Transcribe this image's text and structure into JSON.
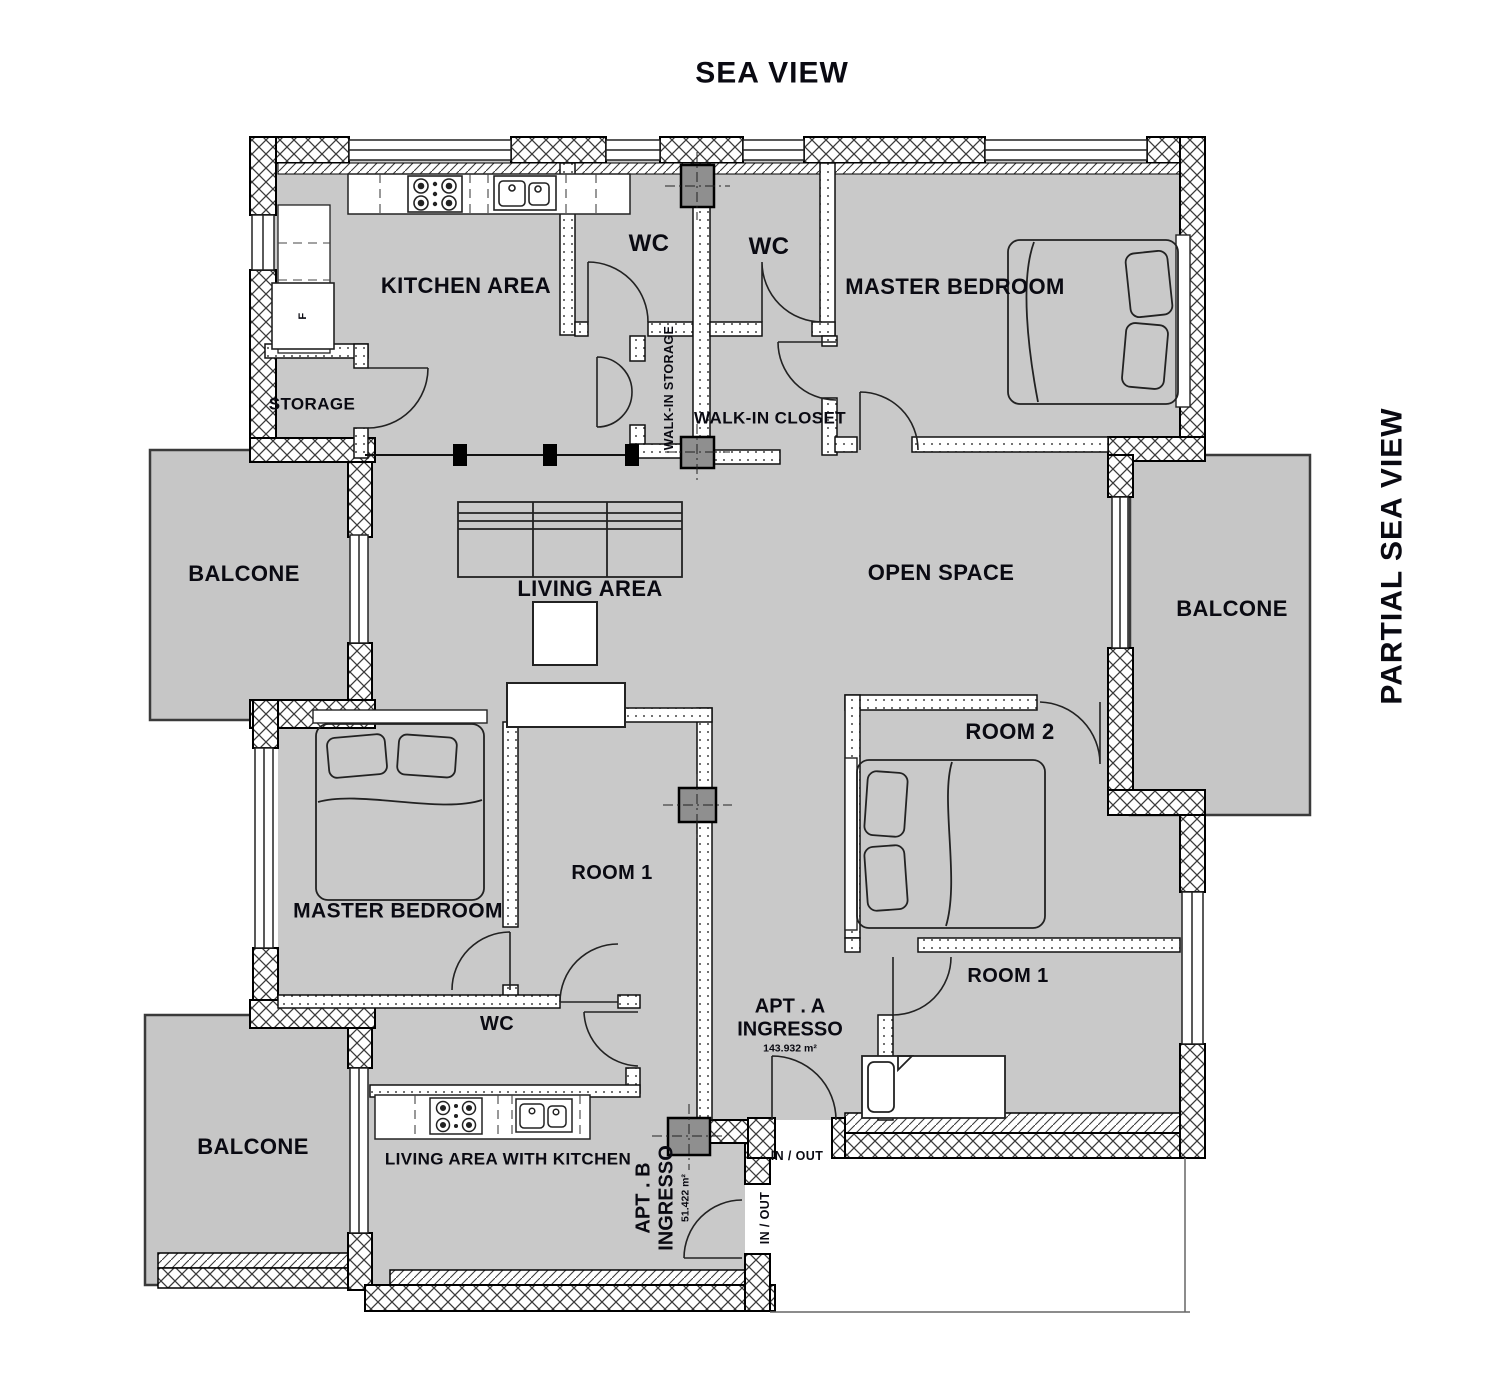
{
  "title": "SEA VIEW",
  "side_title": "PARTIAL SEA VIEW",
  "apt_a": {
    "name": "APT . A",
    "type": "INGRESSO",
    "area": "143.932 m²"
  },
  "apt_b": {
    "name": "APT . B",
    "type": "INGRESSO",
    "area": "51.422 m²"
  },
  "rooms": {
    "kitchen": "KITCHEN AREA",
    "wc1": "WC",
    "wc2": "WC",
    "wc3": "WC",
    "master_top": "MASTER BEDROOM",
    "master_bottom": "MASTER BEDROOM",
    "storage": "STORAGE",
    "walk_in_storage": "WALK-IN STORAGE",
    "walk_in_closet": "WALK-IN CLOSET",
    "balcone_left": "BALCONE",
    "balcone_right": "BALCONE",
    "balcone_bottom": "BALCONE",
    "living": "LIVING AREA",
    "open_space": "OPEN SPACE",
    "room2": "ROOM 2",
    "room1_a": "ROOM 1",
    "room1_b": "ROOM 1",
    "living_kitchen": "LIVING AREA WITH KITCHEN"
  },
  "annotations": {
    "fridge": "F",
    "in_out_a": "IN / OUT",
    "in_out_b": "IN / OUT"
  },
  "colors": {
    "room_fill": "#c9c9c9",
    "balcony_fill": "#c6c6c6",
    "wall_line": "#000000",
    "column_fill": "#8f8f8f",
    "text": "#0a0a12",
    "background": "#ffffff"
  }
}
